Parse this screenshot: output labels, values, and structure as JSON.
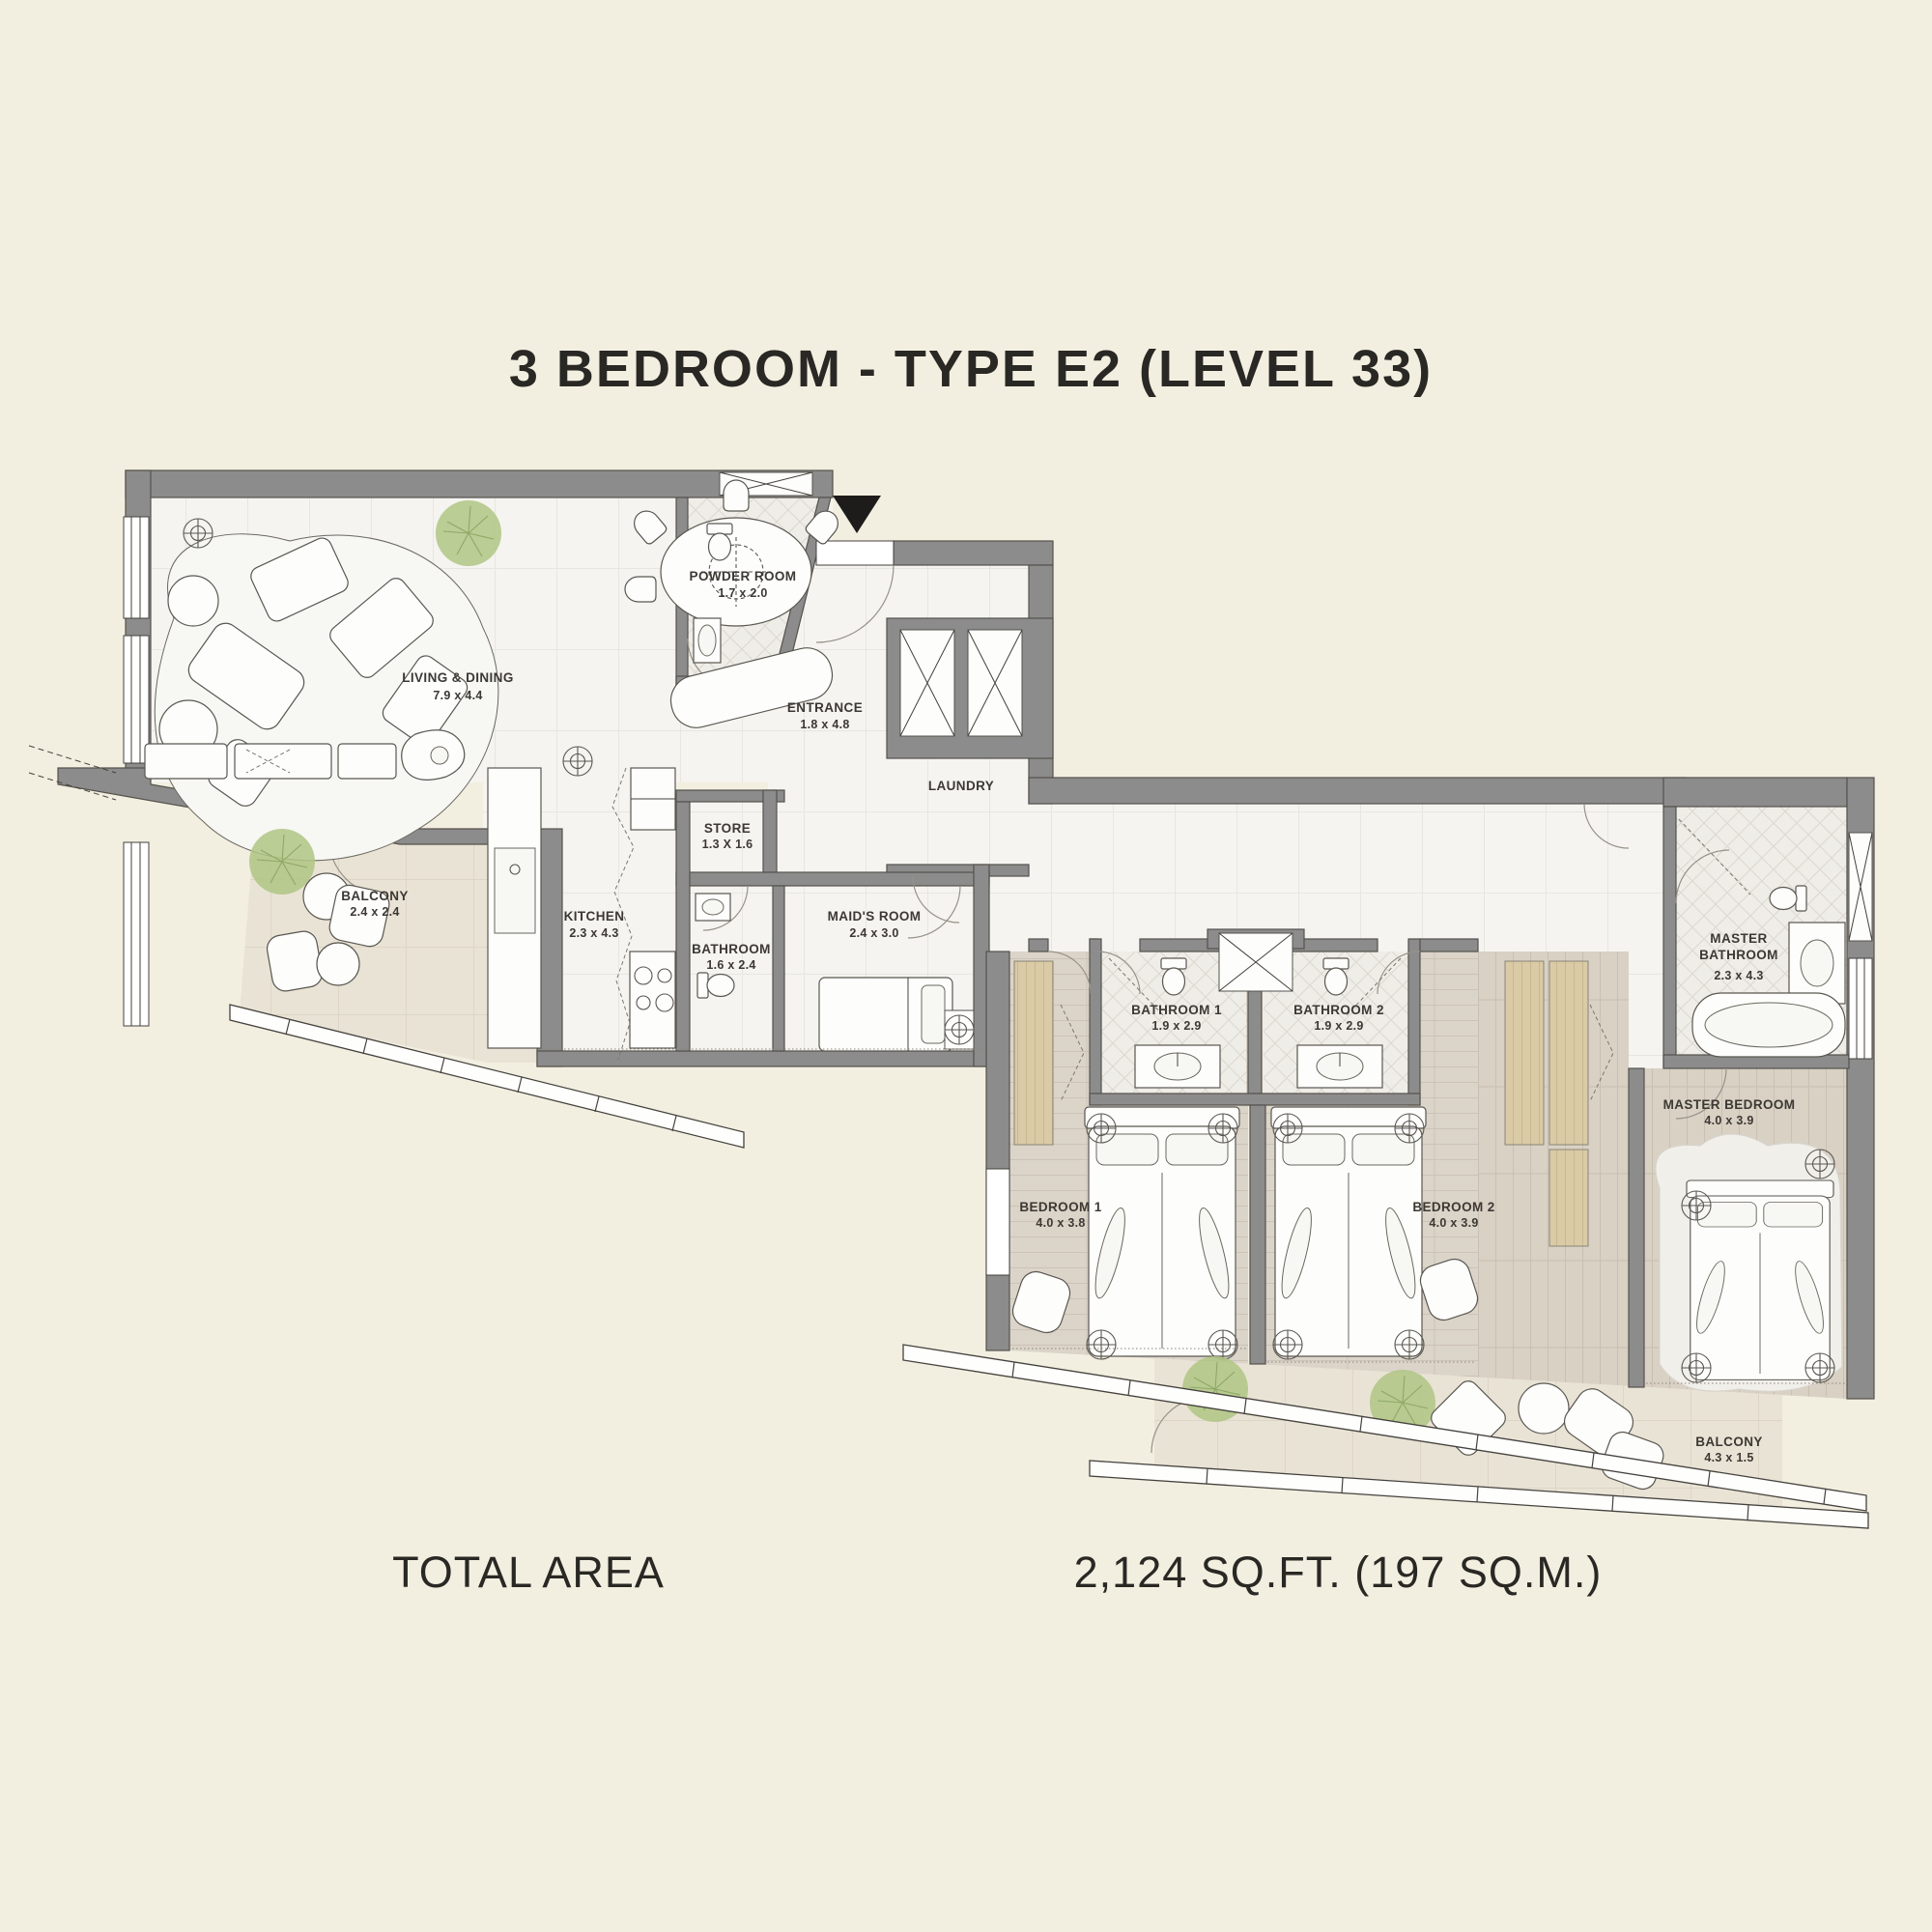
{
  "title": "3 BEDROOM - TYPE E2 (LEVEL 33)",
  "footer": {
    "label": "TOTAL AREA",
    "value": "2,124 SQ.FT. (197 SQ.M.)"
  },
  "rooms": {
    "living_dining": {
      "name": "LIVING & DINING",
      "dims": "7.9 x 4.4"
    },
    "powder_room": {
      "name": "POWDER ROOM",
      "dims": "1.7 x 2.0"
    },
    "entrance": {
      "name": "ENTRANCE",
      "dims": "1.8 x 4.8"
    },
    "laundry": {
      "name": "LAUNDRY"
    },
    "store": {
      "name": "STORE",
      "dims": "1.3 X 1.6"
    },
    "kitchen": {
      "name": "KITCHEN",
      "dims": "2.3 x 4.3"
    },
    "bathroom": {
      "name": "BATHROOM",
      "dims": "1.6 x 2.4"
    },
    "maids_room": {
      "name": "MAID'S ROOM",
      "dims": "2.4 x 3.0"
    },
    "balcony_living": {
      "name": "BALCONY",
      "dims": "2.4 x 2.4"
    },
    "bathroom_1": {
      "name": "BATHROOM 1",
      "dims": "1.9 x 2.9"
    },
    "bathroom_2": {
      "name": "BATHROOM 2",
      "dims": "1.9 x 2.9"
    },
    "bedroom_1": {
      "name": "BEDROOM 1",
      "dims": "4.0 x 3.8"
    },
    "bedroom_2": {
      "name": "BEDROOM 2",
      "dims": "4.0 x 3.9"
    },
    "master_bathroom": {
      "name": "MASTER BATHROOM",
      "name_lines": [
        "MASTER",
        "BATHROOM"
      ],
      "dims": "2.3 x 4.3"
    },
    "master_bedroom": {
      "name": "MASTER BEDROOM",
      "dims": "4.0 x 3.9"
    },
    "balcony_master": {
      "name": "BALCONY",
      "dims": "4.3 x 1.5"
    }
  },
  "icons": {
    "entrance_marker": "entrance-arrow"
  },
  "colors": {
    "background": "#F2EFE0",
    "wall": "#8C8C8C",
    "wall_line": "#55524C",
    "floor": "#F5F4F0",
    "bath_floor": "#EFEDE7",
    "bedroom_floor": "#DBD4C9",
    "balcony_floor": "#E9E3D5",
    "wardrobe": "#DACBA6",
    "plant": "#AFC584",
    "label": "#3C3934",
    "title": "#2A2824"
  }
}
